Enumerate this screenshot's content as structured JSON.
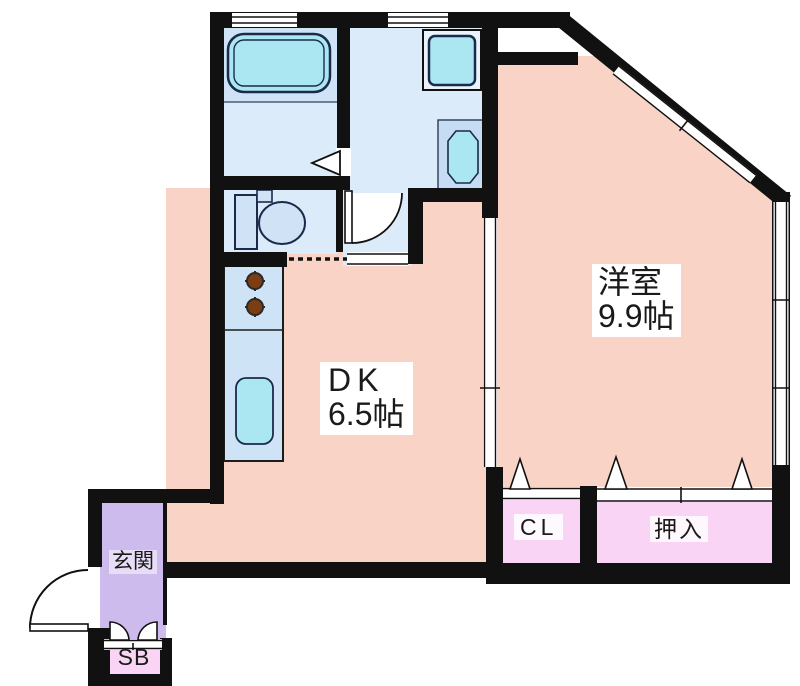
{
  "title": "apartment-floor-plan",
  "rooms": {
    "western_room": {
      "label": "洋室",
      "area": "9.9帖"
    },
    "dining_kitchen": {
      "label": "DK",
      "area": "6.5帖"
    },
    "entrance": {
      "label": "玄関"
    },
    "closet": {
      "label": "CL"
    },
    "futon_closet": {
      "label": "押入"
    },
    "shoe_box": {
      "label": "SB"
    }
  },
  "colors": {
    "room_peach": "#f9d3c5",
    "room_blue": "#dcebfa",
    "bath_blue": "#cfe3f6",
    "fixture_blue": "#cfe2f6",
    "fixture_cyan": "#abe7f2",
    "entrance_lavender": "#cebbee",
    "closet_pink": "#f9d4f4",
    "wall_black": "#111111",
    "outline_navy": "#1b2a4a",
    "burner_brown": "#7c3d12"
  }
}
